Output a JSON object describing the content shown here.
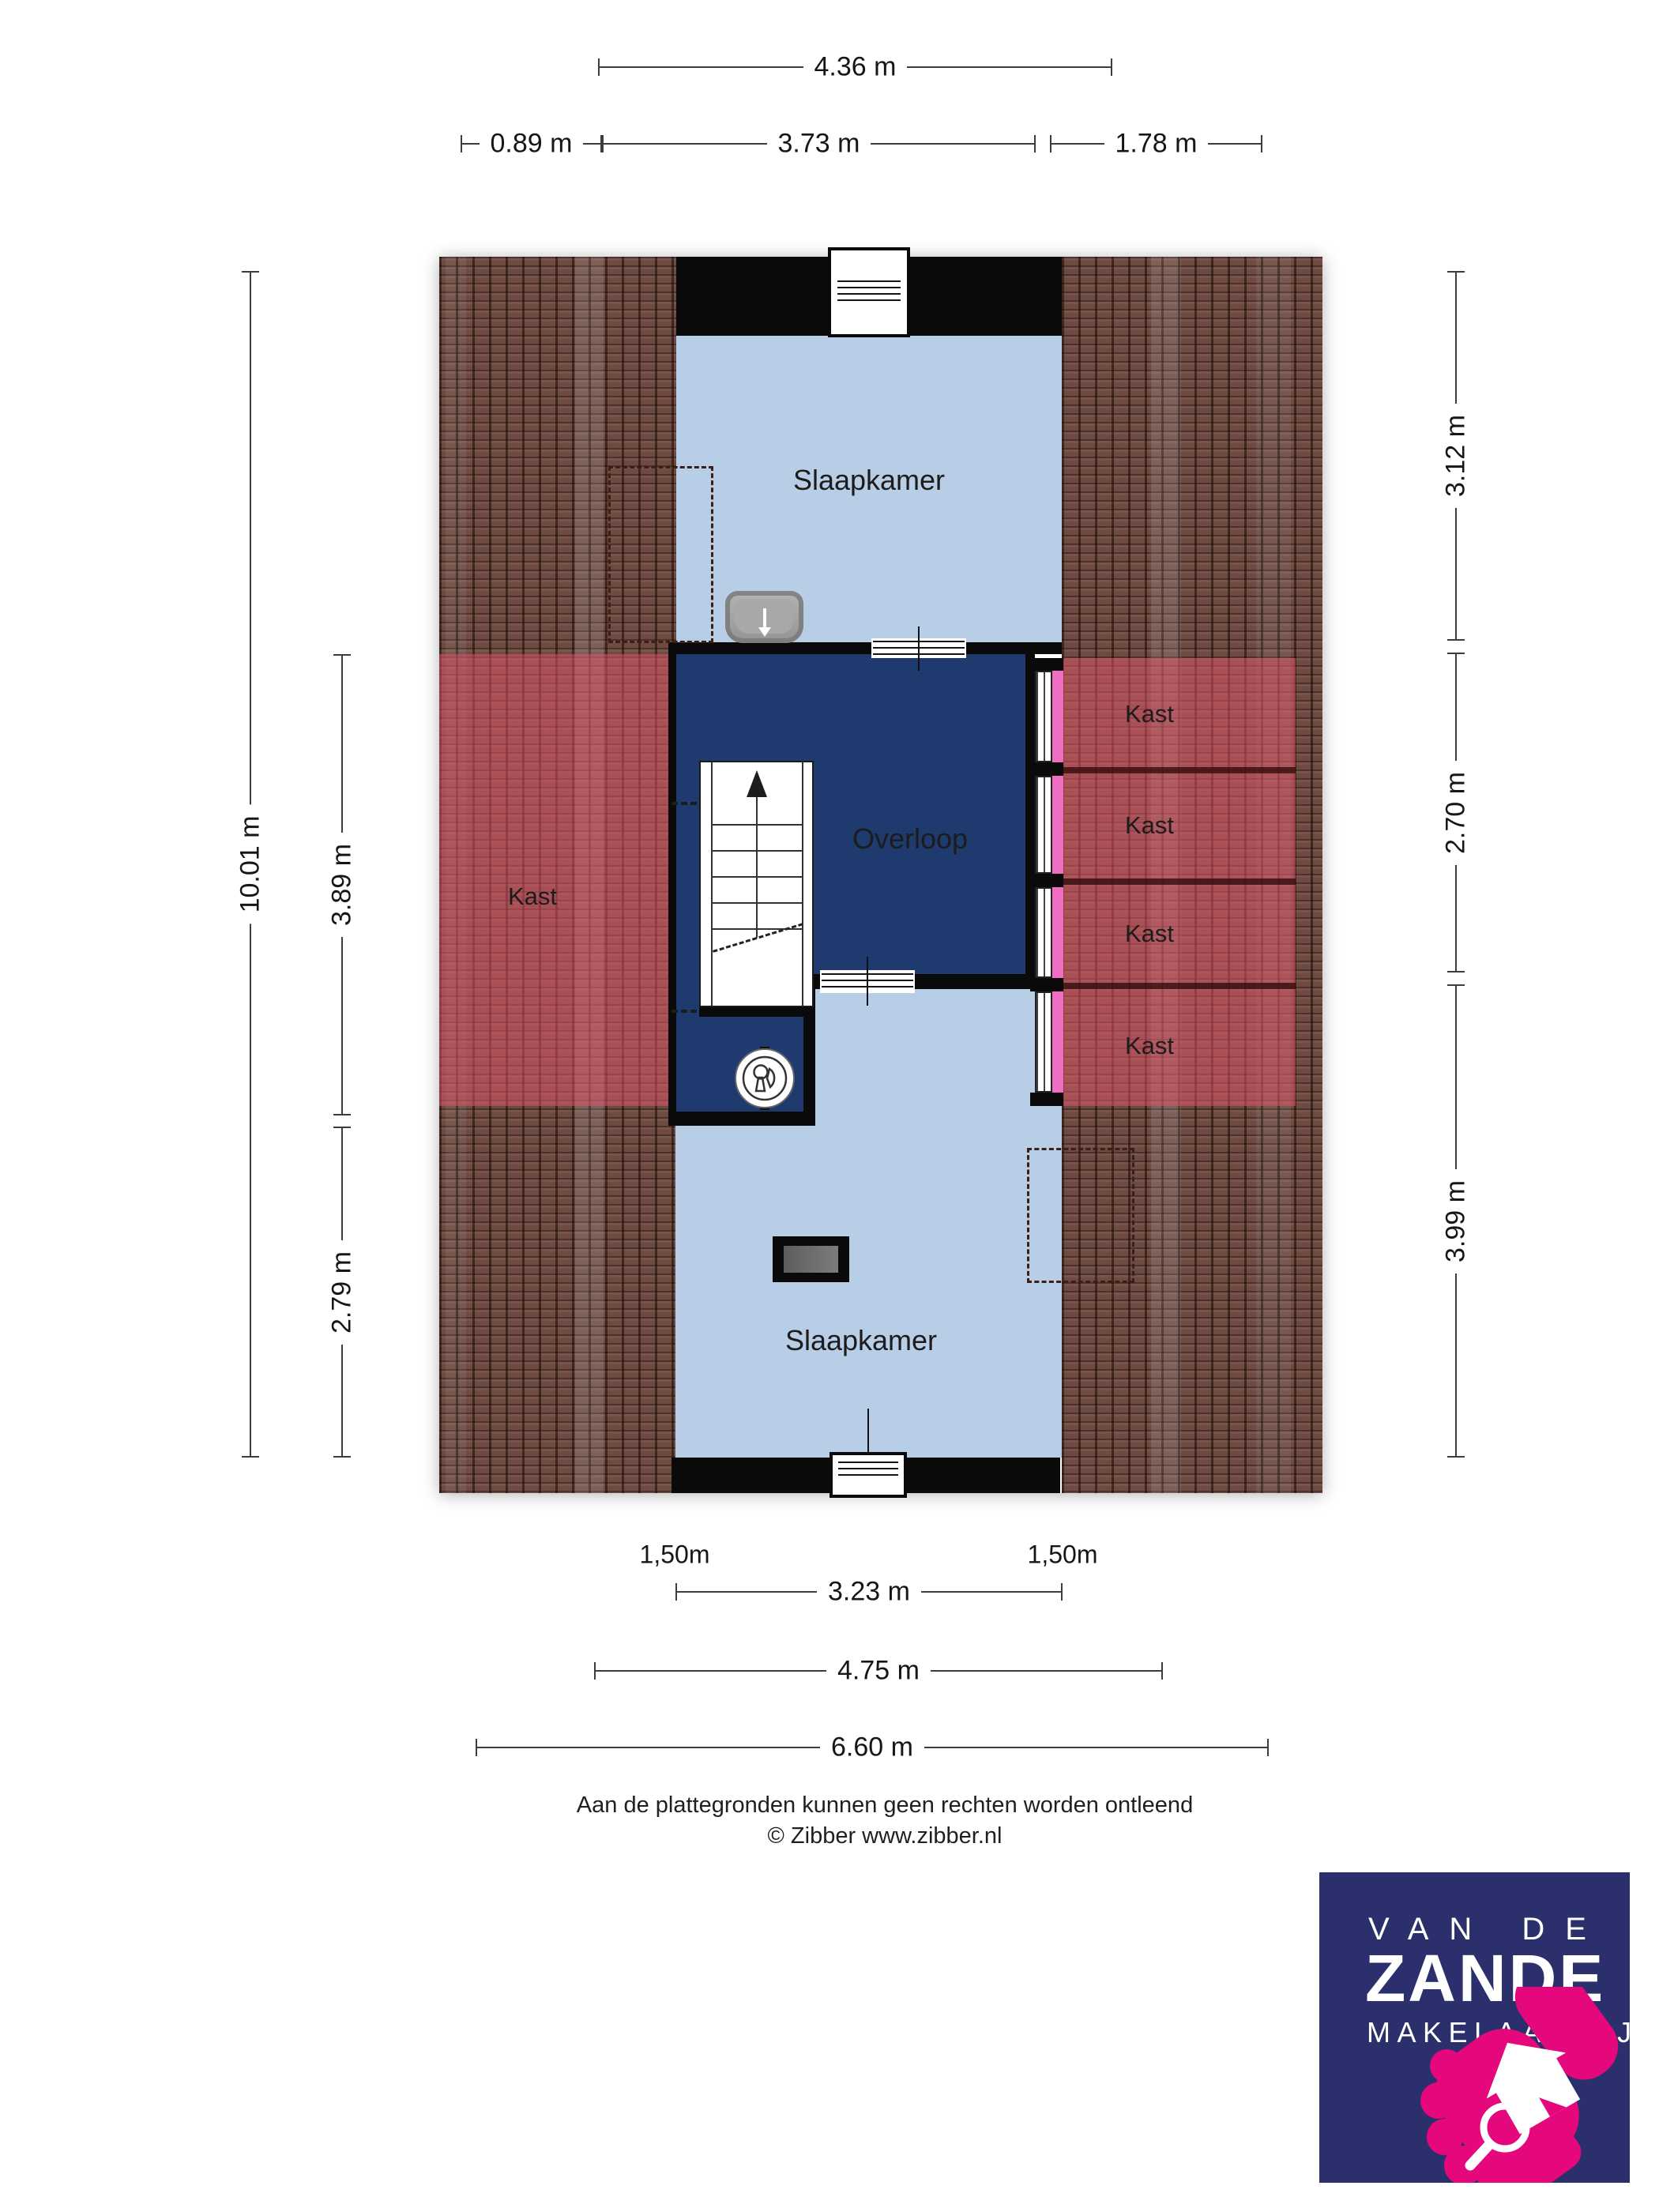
{
  "dimensions": {
    "top": {
      "total": "4.36 m",
      "left": "0.89 m",
      "middle": "3.73 m",
      "right": "1.78 m"
    },
    "left": {
      "total": "10.01 m",
      "upper": "3.89 m",
      "lower": "2.79 m"
    },
    "right": {
      "upper": "3.12 m",
      "middle": "2.70 m",
      "lower": "3.99 m"
    },
    "bottom": {
      "headroom_left": "1,50m",
      "headroom_right": "1,50m",
      "inner": "3.23 m",
      "middle": "4.75 m",
      "total": "6.60 m"
    }
  },
  "rooms": {
    "bedroom_top": "Slaapkamer",
    "landing": "Overloop",
    "bedroom_bottom": "Slaapkamer",
    "closet_left": "Kast",
    "closets_right": [
      "Kast",
      "Kast",
      "Kast",
      "Kast"
    ]
  },
  "footer": {
    "disclaimer": "Aan de plattegronden kunnen geen rechten worden ontleend",
    "credit": "© Zibber www.zibber.nl"
  },
  "logo": {
    "line1": "VAN DE",
    "line2": "ZANDE",
    "line3": "MAKELAARDIJ"
  },
  "colors": {
    "room_fill": "#b8cee6",
    "landing_fill": "#1e3a6e",
    "closet_overlay": "#e0556a",
    "closet_door_pink": "#f06ec2",
    "roof_brown": "#6e4a41",
    "wall_black": "#0a0a0a",
    "logo_navy": "#2b2f6c",
    "logo_pink": "#e5087d"
  }
}
